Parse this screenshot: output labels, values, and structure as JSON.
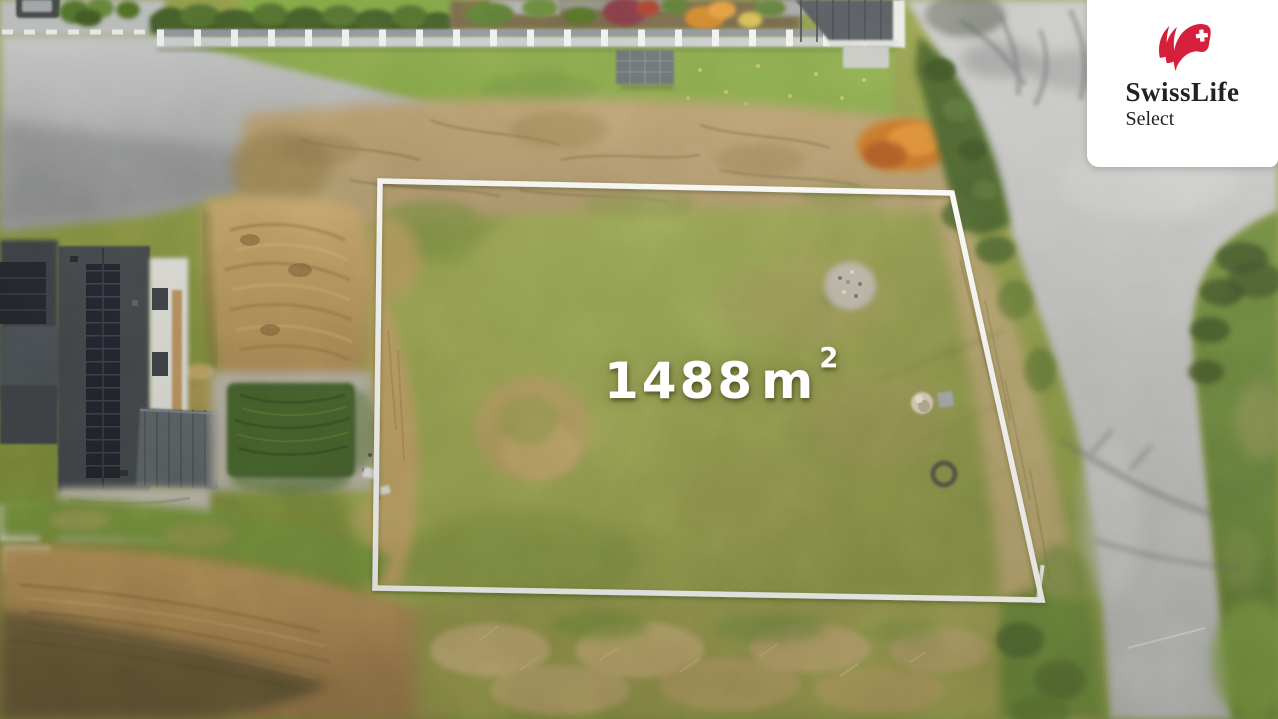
{
  "watermark": {
    "brand": "SwissLife",
    "product": "Select",
    "brand_color": "#d61f3a",
    "text_color": "#232220",
    "card_background": "#ffffff",
    "icon": "swisslife-flag-icon"
  },
  "plot_overlay": {
    "area_label": {
      "value": "1488",
      "unit": "m",
      "superscript": "2"
    },
    "boundary_color": "#ffffff",
    "label_color": "#ffffff"
  },
  "scene_palette": {
    "grass_green": "#95a150",
    "dry_scrub_tan": "#b49a68",
    "road_gray": "#b8b9bb",
    "dirt_brown": "#b08a52",
    "hedge_dark_green": "#3c5722",
    "roof_dark_gray": "#41454c",
    "pool_cover_green": "#42602a"
  }
}
